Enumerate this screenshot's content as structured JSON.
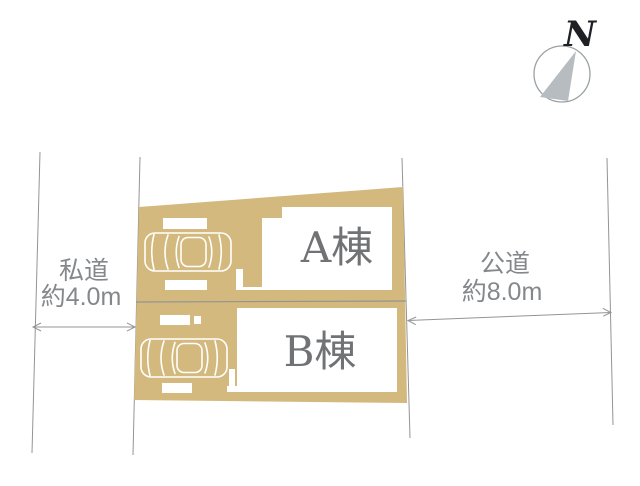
{
  "compass": {
    "label": "N"
  },
  "roads": {
    "left": {
      "name": "私道",
      "width": "約4.0m"
    },
    "right": {
      "name": "公道",
      "width": "約8.0m"
    }
  },
  "buildings": [
    {
      "label": "A棟"
    },
    {
      "label": "B棟"
    }
  ],
  "colors": {
    "lot_fill": "#d3b97e",
    "boundary_line": "#949494",
    "road_label": "#85888b",
    "building_label": "#717274",
    "compass_needle": "#b7bcc0",
    "compass_ring": "#9aa0a4",
    "compass_n": "#1f2023"
  }
}
